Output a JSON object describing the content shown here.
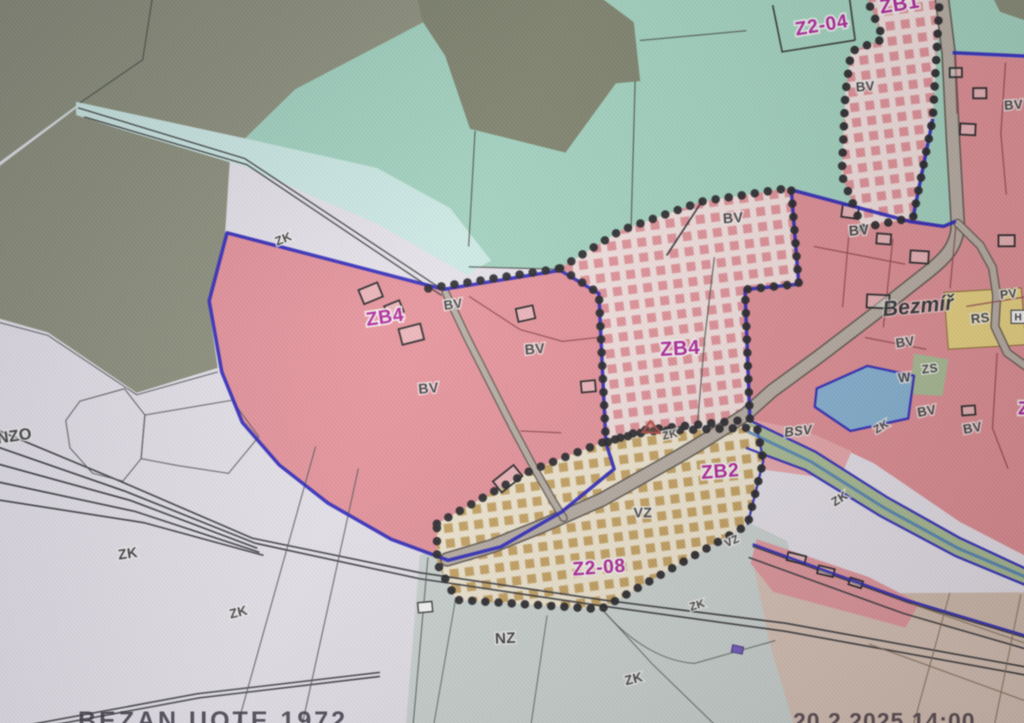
{
  "map": {
    "codes": {
      "bv": "BV",
      "zk": "ZK",
      "vz": "VZ",
      "nz": "NZ",
      "nzo": "NZO",
      "bsv": "BSV",
      "w": "W",
      "zs": "ZS",
      "rs": "RS",
      "pv": "PV",
      "h": "H"
    },
    "zones": {
      "z2_04": "Z2-04",
      "zb1": "ZB1",
      "zb4": "ZB4",
      "zb2": "ZB2",
      "z2_08": "Z2-08",
      "z_clipped": "Z"
    },
    "place_name": "Bezmíř"
  },
  "footer": {
    "left_text": "BEZAN UOTE 1972",
    "right_text": "20.2.2025 14:00"
  },
  "colors": {
    "forest_olive": "#8a8e76",
    "forest_olive_dark": "#7b7f66",
    "meadow_aqua": "#9ed6bf",
    "strip_cyan": "#cdeee8",
    "fields_lavender": "#e9e5ee",
    "zone_pink": "#ee8e97",
    "village_salmon": "#e78b92",
    "bsv_light_pink": "#efa6aa",
    "proposal_check_pink": "#e8878e",
    "proposal_check_tan": "#c69b4d",
    "nz_graygreen": "#ccd6d2",
    "fields_tan": "#dbc4b5",
    "rs_yellow": "#ecd476",
    "water_blue": "#7fb3d9",
    "greenery": "#a7bd90",
    "boundary_blue": "#1c18c6",
    "zone_label_magenta": "#b5189e",
    "road_gray": "#b7aca1"
  }
}
